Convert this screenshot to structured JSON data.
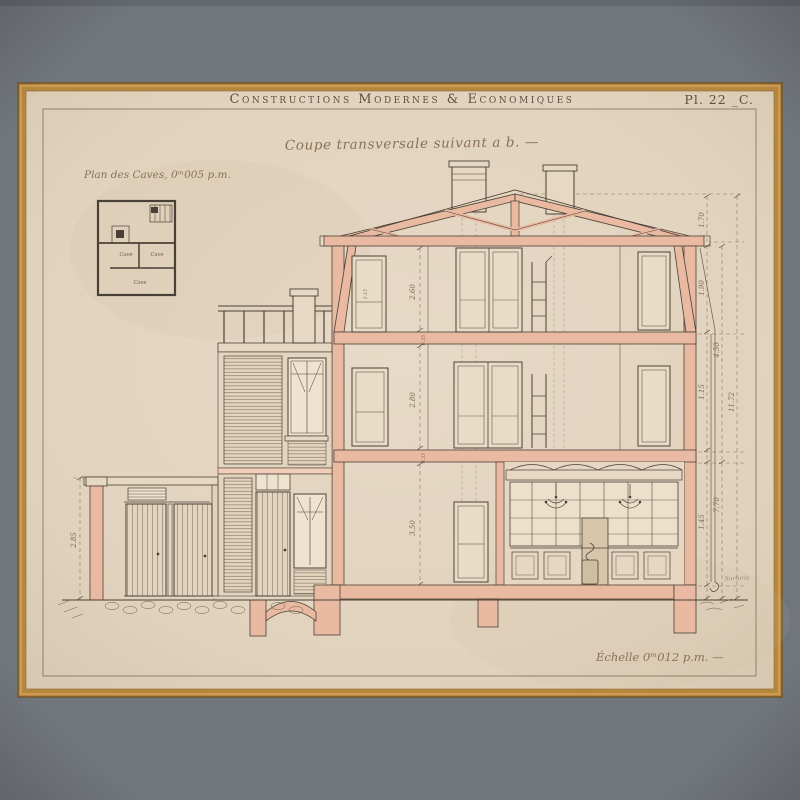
{
  "palette": {
    "mat_grey": "#71767c",
    "frame_gold": "#b8873f",
    "paper_cream": "#e3d5c1",
    "wall_section_pink": "#eab9a1",
    "line_ink": "#4a4136",
    "dimension_ink": "#7c6a54",
    "script_ink": "#8a7155"
  },
  "header": {
    "series_title": "Constructions Modernes & Economiques",
    "plate_number": "Pl. 22 _C."
  },
  "labels": {
    "section_title": "Coupe transversale suivant a b. —",
    "cellar_plan_title": "Plan des Caves, 0ᵐ005 p.m.",
    "scale": "Échelle 0ᵐ012 p.m. —",
    "signature": "Sartoris"
  },
  "cellar_plan": {
    "rooms": [
      "Cave",
      "Cave",
      "Cave"
    ]
  },
  "dimensions": {
    "interior_heights": [
      "2.60",
      "2.80",
      "3.50"
    ],
    "floor_thicknesses": [
      "0.35",
      "0.35",
      "0.45"
    ],
    "right_chain": [
      "1.70",
      "1.90",
      "1.15",
      "1.45"
    ],
    "right_outer": [
      "4.50",
      "7.70"
    ],
    "total_height": "11.72",
    "garage_height": "2.85",
    "attic_door_height": "1.15"
  }
}
